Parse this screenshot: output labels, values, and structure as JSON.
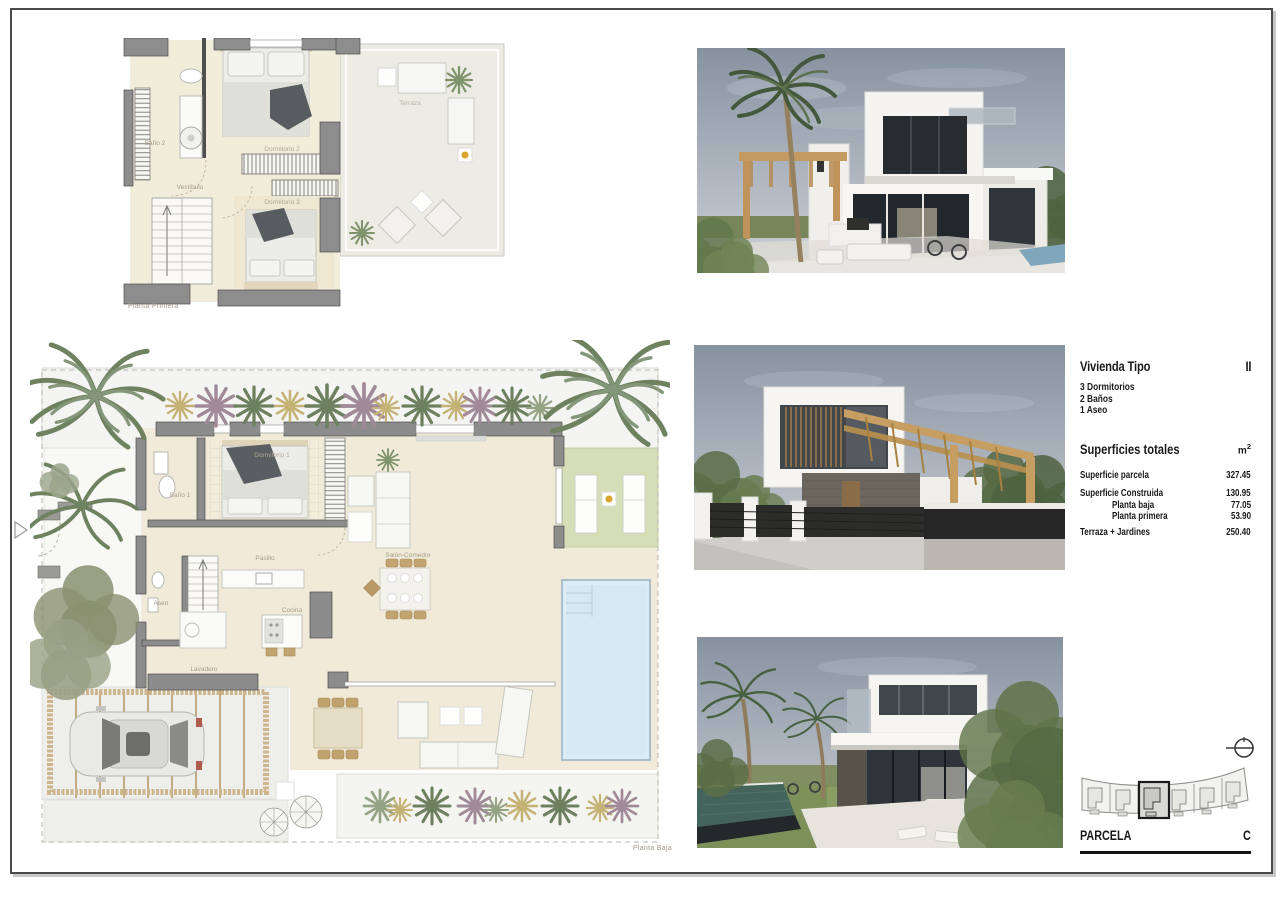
{
  "plans": {
    "planta_primera": {
      "caption": "Planta Primera",
      "rooms": {
        "bano2": "Baño 2",
        "vestibulo": "Vestíbulo",
        "dormitorio2": "Dormitorio 2",
        "dormitorio3": "Dormitorio 3",
        "terraza": "Terraza"
      }
    },
    "planta_baja": {
      "caption": "Planta Baja",
      "rooms": {
        "bano1": "Baño 1",
        "dormitorio1": "Dormitorio 1",
        "pasillo": "Pasillo",
        "aseo": "Aseo",
        "lavadero": "Lavadero",
        "cocina": "Cocina",
        "salon_comedor": "Salón-Comedor"
      }
    }
  },
  "info_panel": {
    "title": "Vivienda Tipo",
    "type_code": "II",
    "features": [
      "3 Dormitorios",
      "2 Baños",
      "1 Aseo"
    ],
    "surfaces_heading": "Superficies totales",
    "unit": "m",
    "unit_exp": "2",
    "surface_rows": [
      {
        "label": "Superficie parcela",
        "value": "327.45"
      },
      {
        "label": "Superficie Construida",
        "value": "130.95"
      },
      {
        "label": "Planta baja",
        "value": "77.05"
      },
      {
        "label": "Planta primera",
        "value": "53.90"
      },
      {
        "label": "Terraza + Jardines",
        "value": "250.40"
      }
    ]
  },
  "parcel_block": {
    "label": "PARCELA",
    "code": "C",
    "plot_count": 6,
    "highlighted_plot": 3
  },
  "colors": {
    "floor_cream": "#f2ecdb",
    "wall_grey": "#8d8d8d",
    "pool_blue": "#dcecf4",
    "lawn_green": "#d5deb6",
    "wood_tan": "#cdb68d",
    "sky_slate": "#8792a1",
    "vegetation_green": "#6d8060"
  }
}
